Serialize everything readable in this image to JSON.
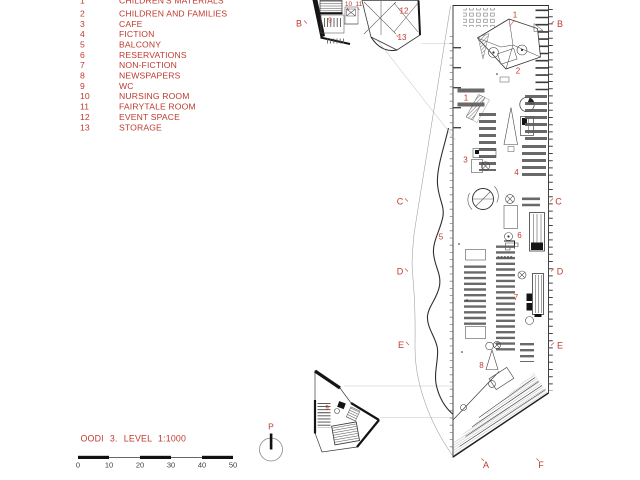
{
  "colors": {
    "accent": "#bf3a2e",
    "line": "#3a3a3a",
    "faint": "#c4c4c4"
  },
  "legend": {
    "items": [
      {
        "num": "1",
        "label": "CHILDREN'S MATERIALS"
      },
      {
        "num": "2",
        "label": "CHILDREN AND FAMILIES"
      },
      {
        "num": "3",
        "label": "CAFE"
      },
      {
        "num": "4",
        "label": "FICTION"
      },
      {
        "num": "5",
        "label": "BALCONY"
      },
      {
        "num": "6",
        "label": "RESERVATIONS"
      },
      {
        "num": "7",
        "label": "NON-FICTION"
      },
      {
        "num": "8",
        "label": "NEWSPAPERS"
      },
      {
        "num": "9",
        "label": "WC"
      },
      {
        "num": "10",
        "label": "NURSING ROOM"
      },
      {
        "num": "11",
        "label": "FAIRYTALE ROOM"
      },
      {
        "num": "12",
        "label": "EVENT SPACE"
      },
      {
        "num": "13",
        "label": "STORAGE"
      }
    ]
  },
  "titleblock": {
    "title": "OODI 3. LEVEL 1:1000"
  },
  "scalebar": {
    "labels": [
      "0",
      "10",
      "20",
      "30",
      "40",
      "50"
    ]
  },
  "north": {
    "label": "P"
  },
  "plan": {
    "section_markers": {
      "left": [
        "B",
        "C",
        "D",
        "E"
      ],
      "right": [
        "B",
        "C",
        "D",
        "E"
      ],
      "bottom": [
        "A",
        "F"
      ]
    },
    "room_labels": {
      "main": [
        "1",
        "2",
        "1",
        "3",
        "4",
        "5",
        "6",
        "7",
        "8"
      ],
      "annex_top": [
        "9",
        "10",
        "11",
        "12",
        "13"
      ],
      "annex_bottom": [
        "9"
      ]
    }
  }
}
